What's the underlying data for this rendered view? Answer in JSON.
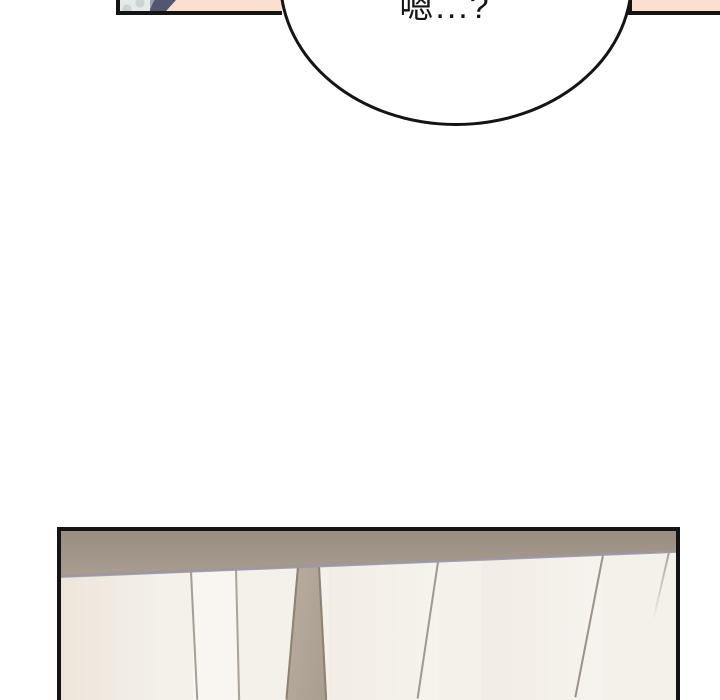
{
  "colors": {
    "page-bg": "#ffffff",
    "ink": "#141414",
    "bubble-fill": "#ffffff",
    "skin": "#fbdfd0",
    "hair-gray": "#e6e9ea",
    "hair-curl": "#ccd3d6",
    "clothing-slate": "#515770",
    "clothing-light": "#9aa1b1",
    "wall-taupe-dark": "#998d81",
    "wall-taupe": "#ab9e92",
    "band-edge-gray": "#9a98a3",
    "door-cream": "#f4f0ea",
    "door-streak": "#ebe3d7",
    "seam-brown": "#8b8175",
    "diag-band-light": "#b9aea1",
    "diag-band-dark": "#a89c8e",
    "diag-edge": "#8d8173"
  },
  "speech_bubble": {
    "text": "嗯...?"
  }
}
